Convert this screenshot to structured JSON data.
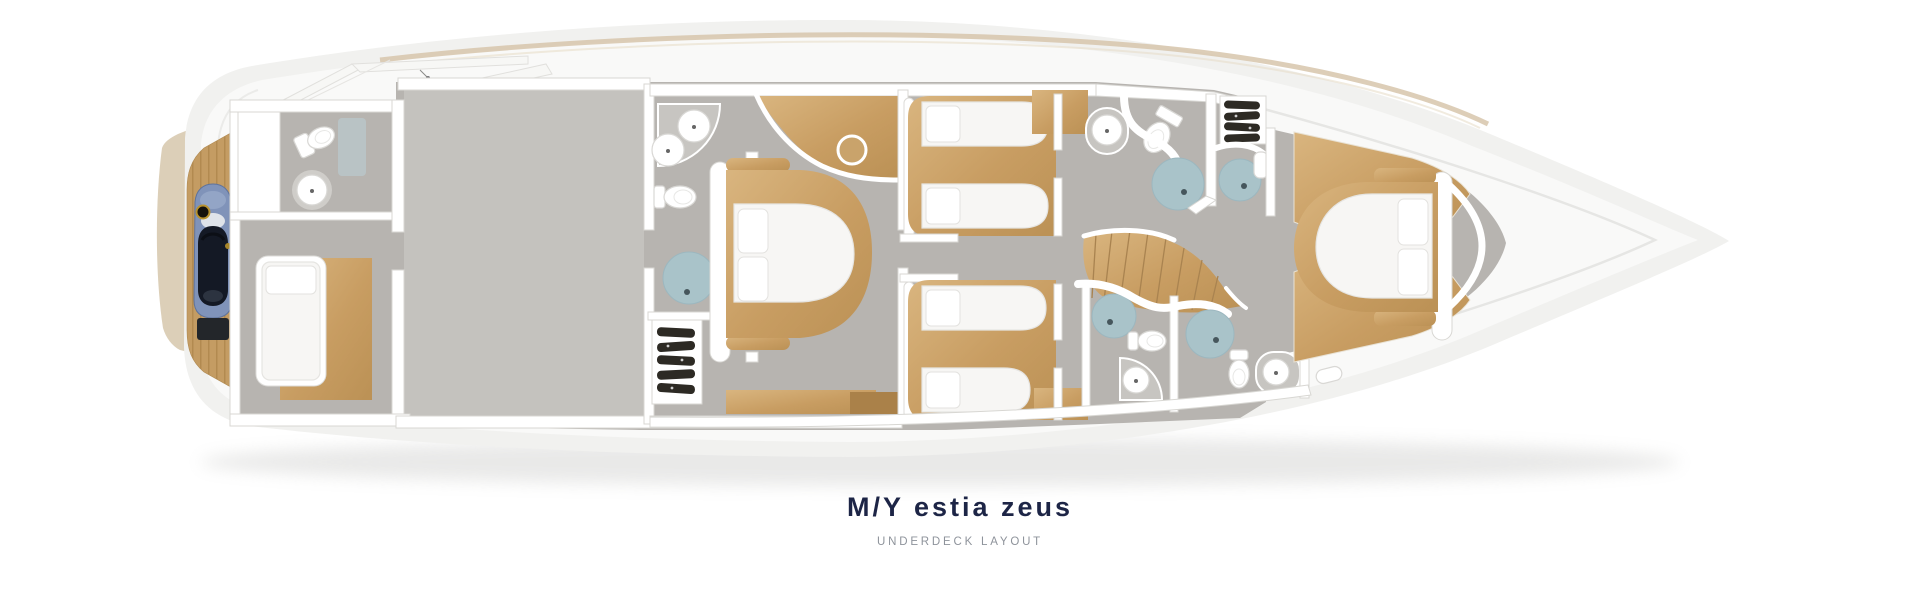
{
  "header": {
    "title": "M/Y estia zeus",
    "subtitle": "UNDERDECK LAYOUT"
  },
  "colors": {
    "title_navy": "#1d2546",
    "subtitle_gray": "#8e939b",
    "hull_outer": "#f1f1ef",
    "hull_inner": "#f9f9f8",
    "interior_floor": "#b7b4b0",
    "engine_floor": "#c4c2be",
    "wood": "#c89d62",
    "wood_light": "#d9b57f",
    "shower_blue": "#a9c3c9",
    "wall_white": "#ffffff",
    "deck_trim_beige": "#d7c6ab",
    "jetski_blue": "#8093b9",
    "jetski_dark": "#141925",
    "wardrobe_clothes": "#2d2a24"
  },
  "plan": {
    "type": "yacht-deck-floor-plan",
    "view": "top-down",
    "rooms": [
      {
        "id": "stern-garage",
        "furniture": [
          "jet-ski",
          "teak-deck"
        ]
      },
      {
        "id": "crew-bathroom",
        "furniture": [
          "toilet",
          "round-sink"
        ]
      },
      {
        "id": "crew-cabin",
        "furniture": [
          "single-bed"
        ]
      },
      {
        "id": "engine-room",
        "furniture": []
      },
      {
        "id": "master-bathroom",
        "furniture": [
          "double-sink-counter",
          "toilet",
          "round-shower"
        ]
      },
      {
        "id": "master-cabin",
        "furniture": [
          "double-bed",
          "wardrobe",
          "round-stool"
        ]
      },
      {
        "id": "twin-cabin-port",
        "furniture": [
          "twin-bed",
          "twin-bed",
          "nightstand"
        ]
      },
      {
        "id": "twin-cabin-starboard",
        "furniture": [
          "twin-bed",
          "twin-bed",
          "nightstand"
        ]
      },
      {
        "id": "guest-bathroom-forward",
        "furniture": [
          "round-sink",
          "toilet",
          "round-shower"
        ]
      },
      {
        "id": "guest-bathroom-aft-left",
        "furniture": [
          "round-shower",
          "toilet",
          "corner-sink"
        ]
      },
      {
        "id": "guest-bathroom-aft-right",
        "furniture": [
          "round-shower",
          "toilet",
          "counter-sink"
        ]
      },
      {
        "id": "hallway-staircase",
        "furniture": [
          "curved-stairs"
        ]
      },
      {
        "id": "vip-bow-cabin",
        "furniture": [
          "double-bed",
          "scalloped-cabinet",
          "scalloped-cabinet",
          "wardrobe"
        ]
      }
    ]
  }
}
